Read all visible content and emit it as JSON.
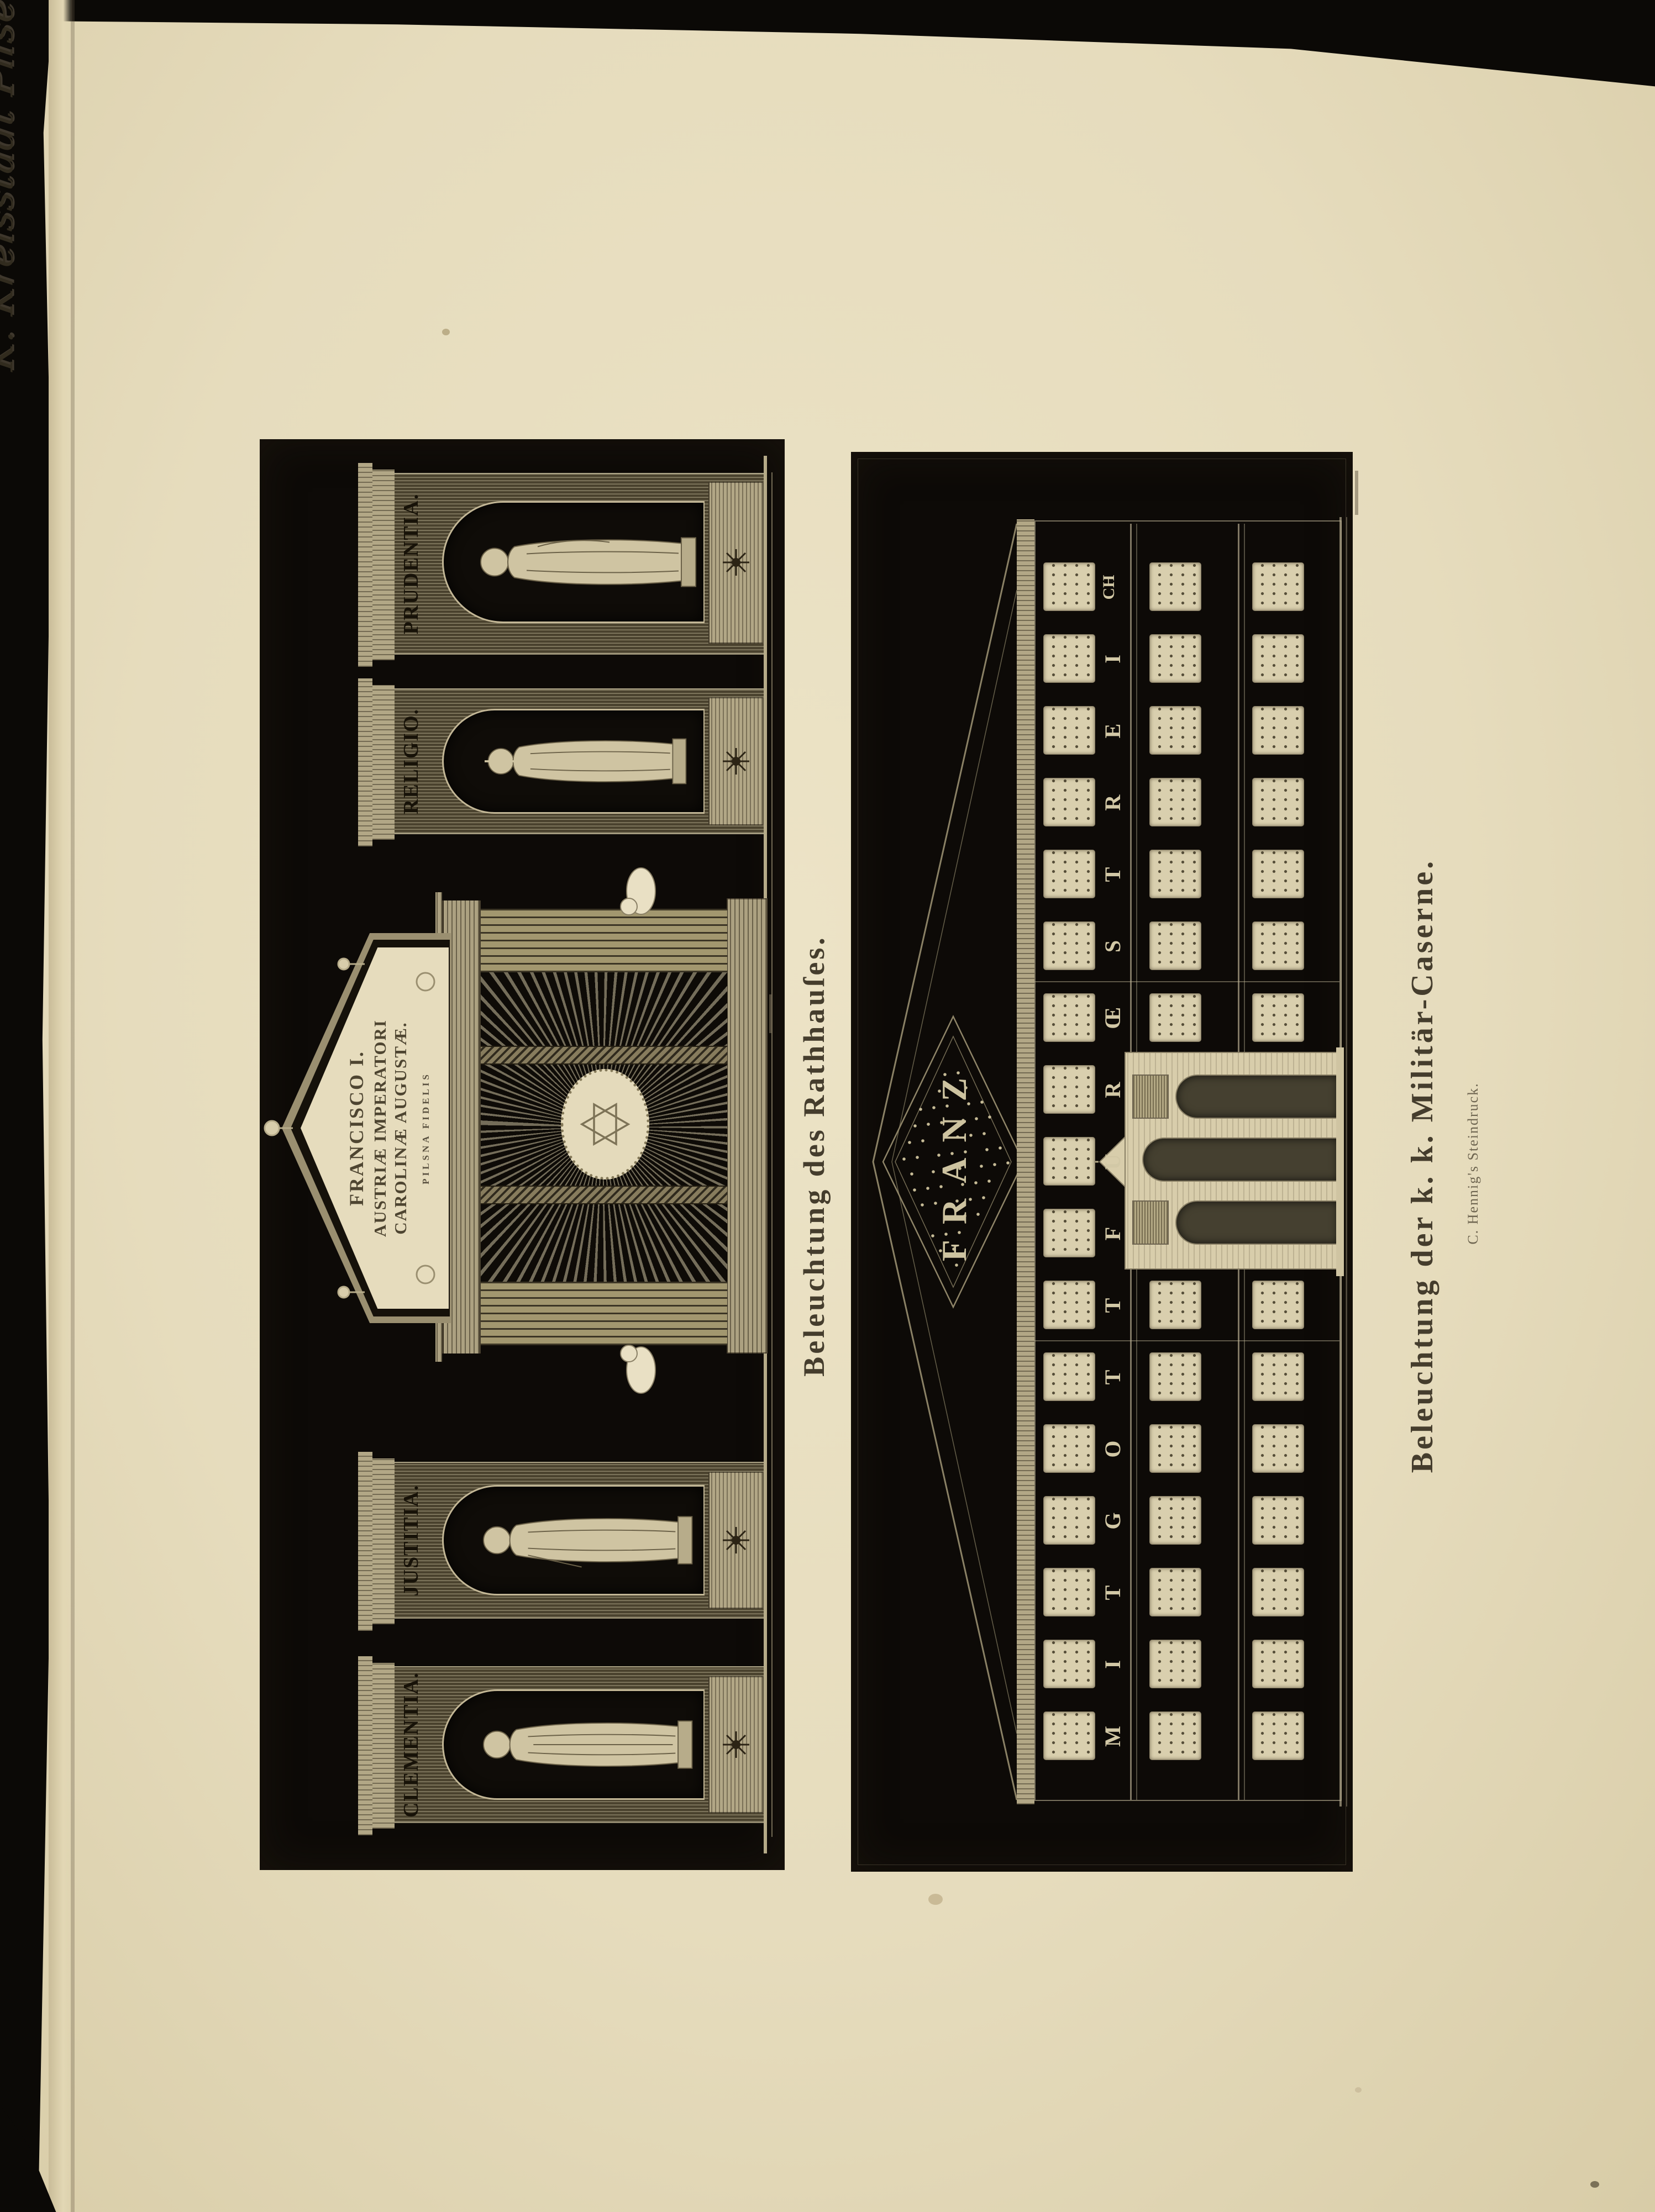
{
  "page": {
    "handwritten_note": "K. Kreisstadt Pilsen, am 2. August.",
    "paper_color": "#e6dcbd",
    "plate_color": "#0d0a07",
    "engraving_light": "#cdc3a2"
  },
  "plates": {
    "rathhaus": {
      "caption": "Beleuchtung des Rathhauſes.",
      "pediment_inscription": [
        "FRANCISCO I.",
        "AUSTRIÆ IMPERATORI",
        "CAROLINÆ AUGUSTÆ.",
        "PILSNA FIDELIS"
      ],
      "niche_labels": [
        "CLEMENTIA.",
        "JUSTITIA.",
        "RELIGIO.",
        "PRUDENTIA."
      ]
    },
    "caserne": {
      "caption": "Beleuchtung der k. k. Militär-Caserne.",
      "imprint": "C. Hennig's Steindruck.",
      "roof_title": "FRANZ",
      "facade_motto": "MIT GOTT FUR ŒSTREICH",
      "motto_letters": [
        "M",
        "I",
        "T",
        "G",
        "O",
        "T",
        "T",
        "F",
        "U",
        "R",
        "Œ",
        "S",
        "T",
        "R",
        "E",
        "I",
        "CH"
      ],
      "storeys": {
        "top_window_count": 17,
        "middle_window_count": 14,
        "ground_window_count": 14,
        "pavilion_bays": [
          7,
          8,
          9
        ]
      }
    }
  }
}
